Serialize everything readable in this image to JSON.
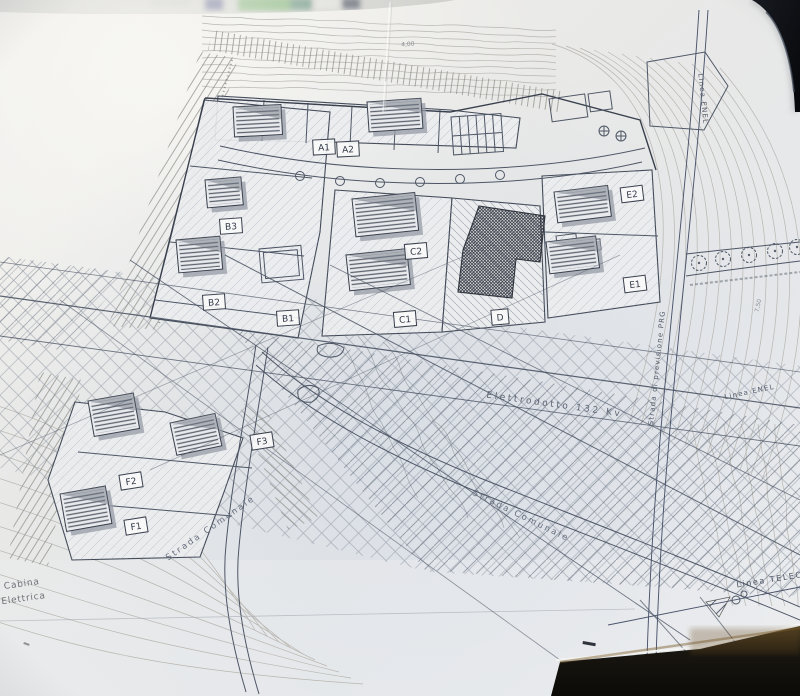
{
  "drawing": {
    "lots": {
      "a1": "A1",
      "a2": "A2",
      "b1": "B1",
      "b2": "B2",
      "b3": "B3",
      "c1": "C1",
      "c2": "C2",
      "d": "D",
      "e1": "E1",
      "e2": "E2",
      "f1": "F1",
      "f2": "F2",
      "f3": "F3"
    },
    "roads": {
      "strada_1": "Strada Comunale",
      "strada_2": "Strada Comunale"
    },
    "utilities": {
      "elettrodotto": "Elettrodotto 132 Kv",
      "prg": "Strada di previsione PRG",
      "enel_top": "Linea ENEL",
      "enel_diag": "Linea ENEL",
      "telecom": "Linea TELECOM"
    },
    "structures": {
      "cabina_1": "Cabina",
      "cabina_2": "Elettrica"
    },
    "elevations": {
      "contour": "4,00",
      "spot": "7,50"
    }
  },
  "colors": {
    "paper": "#ECECEB",
    "ink": "#495363",
    "contour": "#B8B6B0",
    "table_dark": "#14110B",
    "device_black": "#0B0D10",
    "blur_green": "#6AA560"
  }
}
